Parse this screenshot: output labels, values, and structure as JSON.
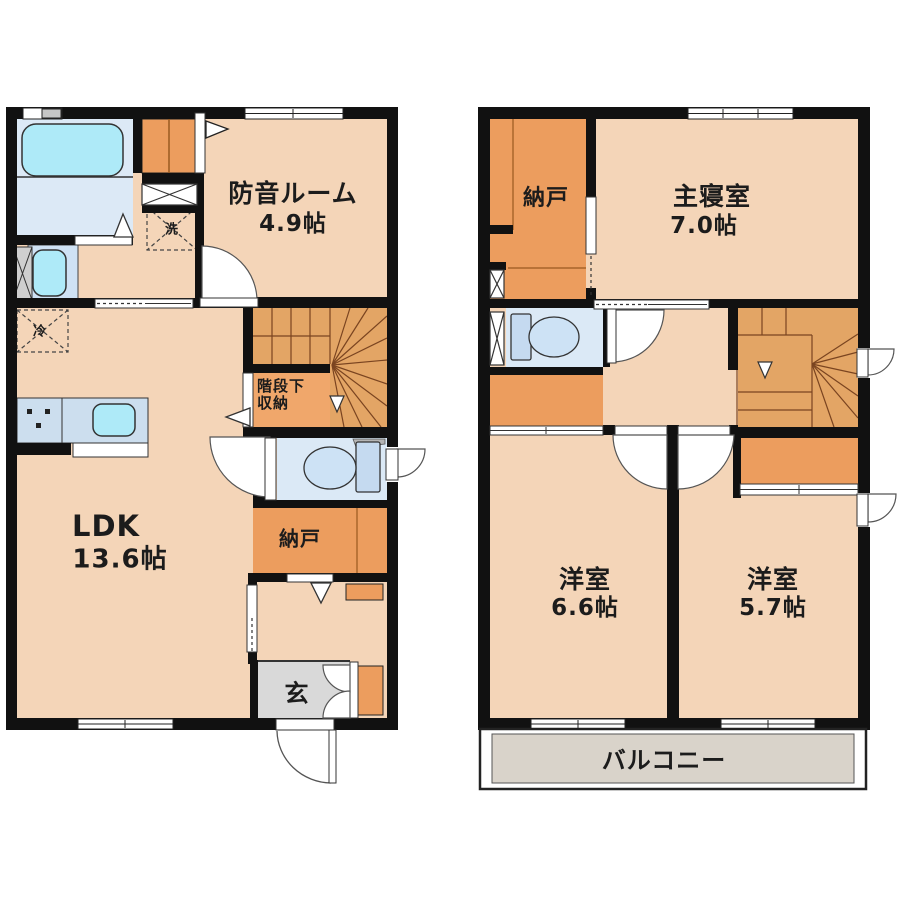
{
  "title": "2-story floor plan",
  "floor1": {
    "soundproof_room": {
      "name": "防音ルーム",
      "area": "4.9帖"
    },
    "ldk": {
      "name": "LDK",
      "area": "13.6帖"
    },
    "under_stair_storage": {
      "line1": "階段下",
      "line2": "収納"
    },
    "storage": {
      "name": "納戸"
    },
    "entrance": {
      "name": "玄"
    },
    "washer": {
      "name": "洗"
    },
    "fridge": {
      "name": "冷"
    }
  },
  "floor2": {
    "storage": {
      "name": "納戸"
    },
    "master_bedroom": {
      "name": "主寝室",
      "area": "7.0帖"
    },
    "western_room_left": {
      "name": "洋室",
      "area": "6.6帖"
    },
    "western_room_right": {
      "name": "洋室",
      "area": "5.7帖"
    },
    "balcony": {
      "name": "バルコニー"
    }
  },
  "colors": {
    "floor": "#f4d5b8",
    "closet_orange": "#ec9d5e",
    "stairs_orange": "#e3a565",
    "stair_storage_orange": "#f0a76b",
    "bath_blue": "#dce9f6",
    "fixture_cyan": "#aeeaf8",
    "counter_blue": "#ccdeee",
    "entrance_gray": "#d9d9d9",
    "balcony_gray": "#d9d3ca",
    "wall_black": "#111111"
  }
}
